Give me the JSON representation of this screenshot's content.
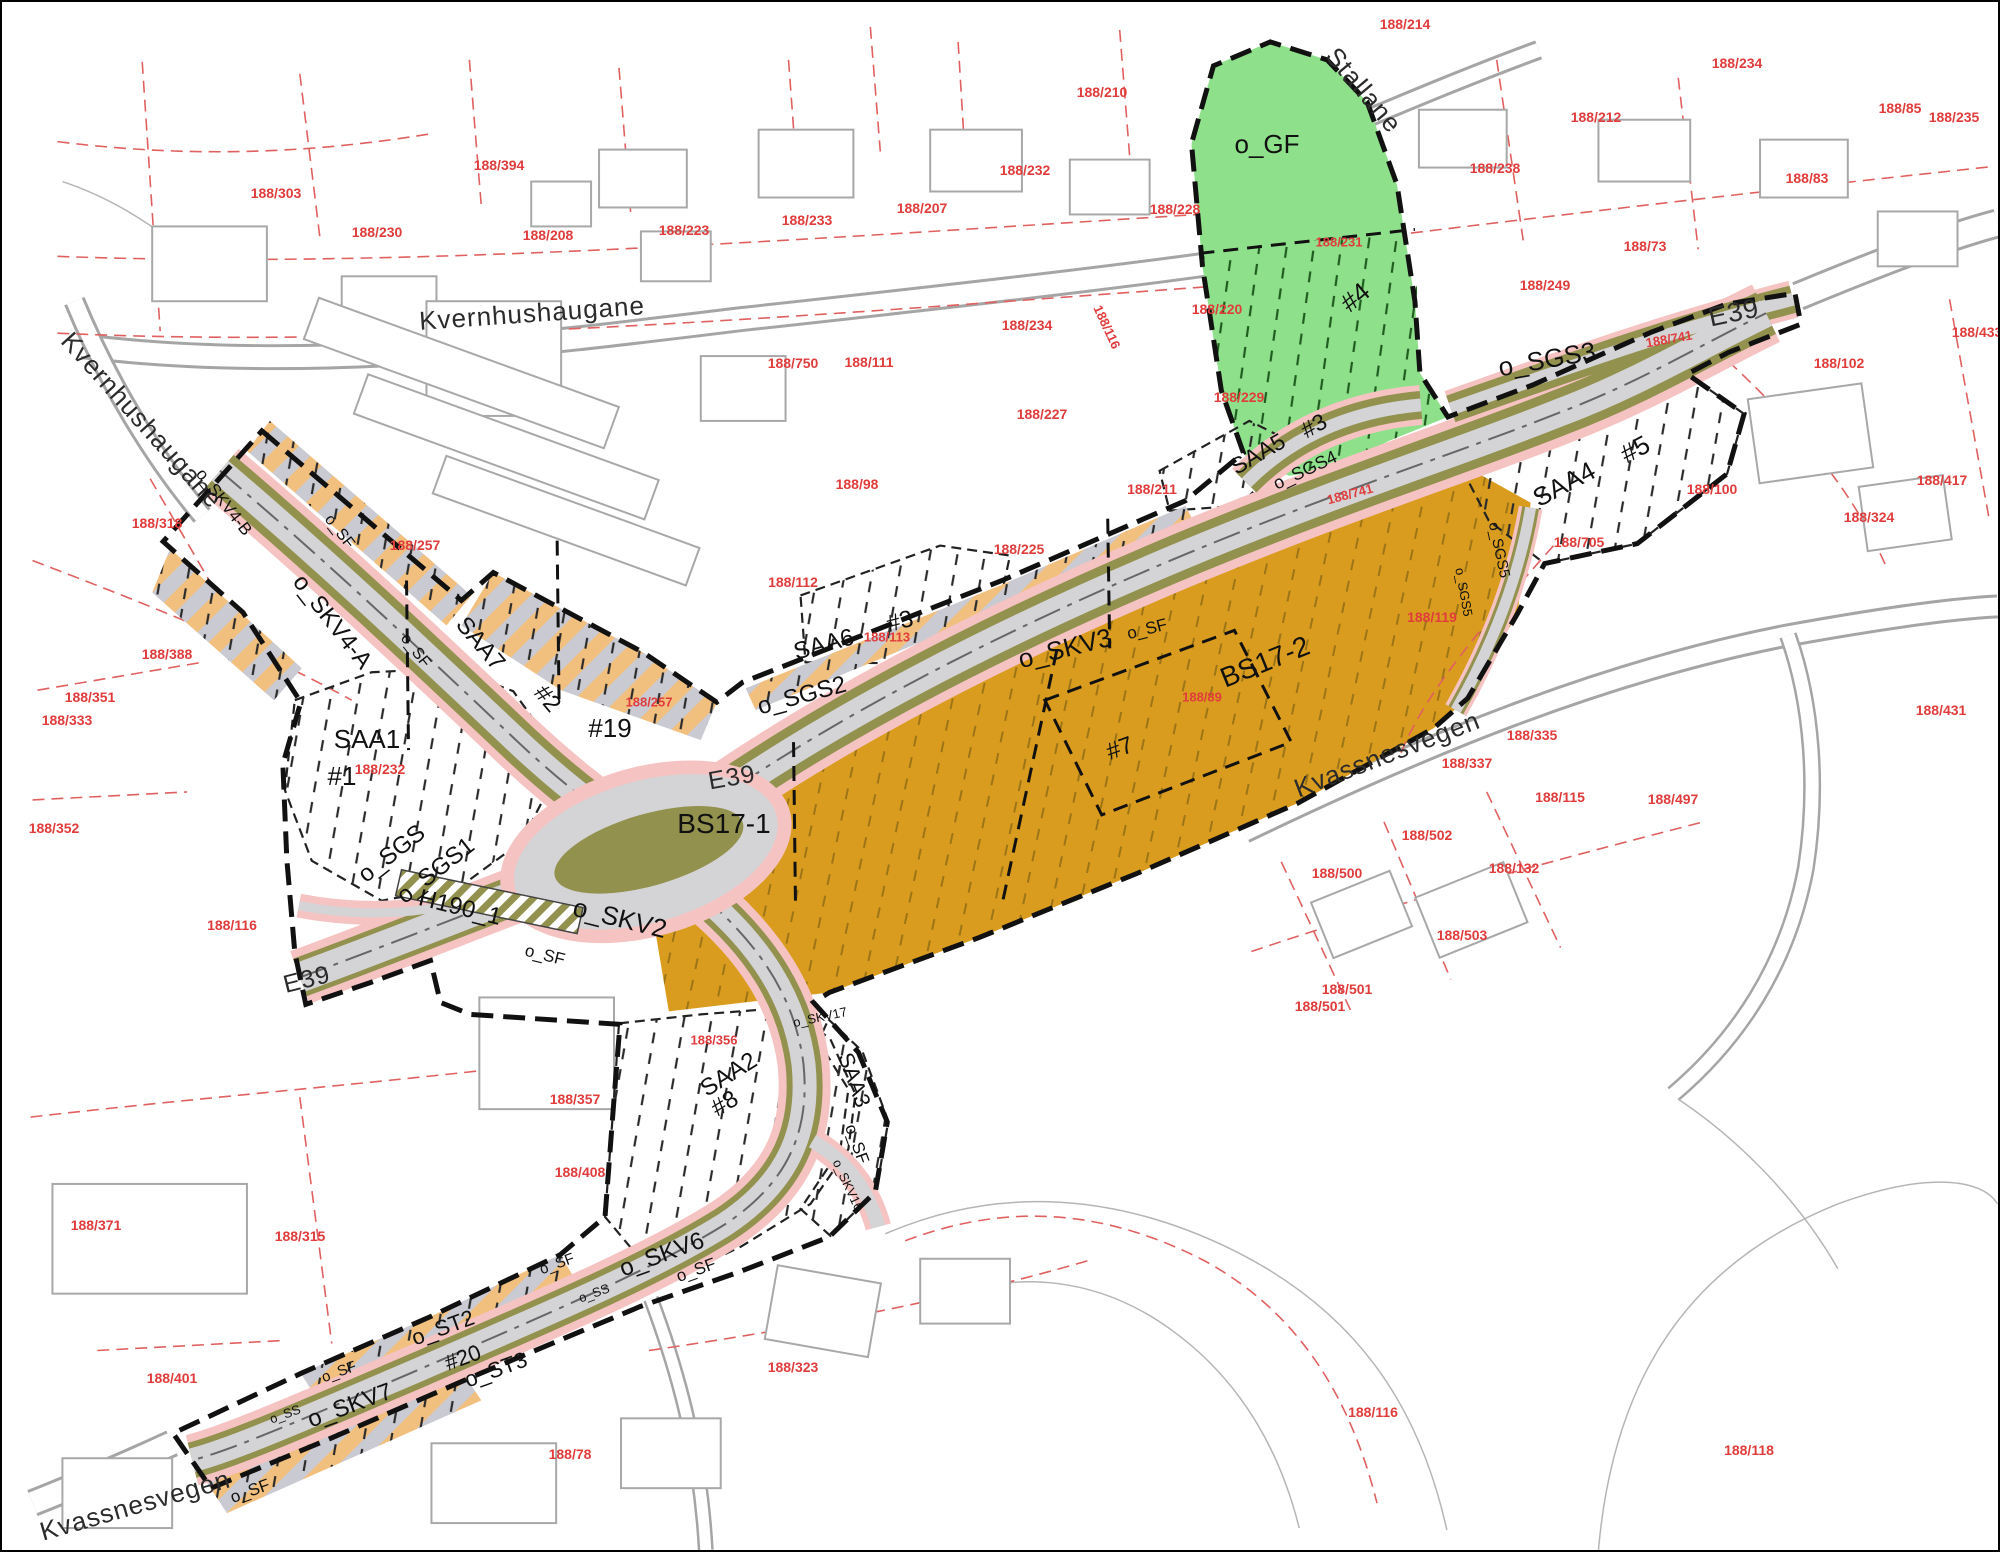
{
  "map": {
    "type": "zoning-plan (reguleringsplan) map",
    "palette": {
      "green": "#8fe08b",
      "olive": "#93914e",
      "orange": "#d99c1e",
      "roadgrey": "#d4d4d6",
      "pink": "#f5c3c2",
      "hatch_orange": "#f2c07e",
      "hatch_grey": "#c9cad2",
      "parcel_red": "#e03c3c",
      "parcel_line": "#e06060",
      "ink": "#111111",
      "street_ink": "#2b2b2b",
      "bldg": "#a8a8a8"
    },
    "labels": {
      "streets": [
        {
          "t": "Kvernhushaugane",
          "x": 530,
          "y": 311,
          "r": -4,
          "s": 26
        },
        {
          "t": "Kvernhushaugane",
          "x": 140,
          "y": 418,
          "r": 48,
          "s": 26
        },
        {
          "t": "Stallane",
          "x": 1362,
          "y": 88,
          "r": 50,
          "s": 26
        },
        {
          "t": "E39",
          "x": 1732,
          "y": 311,
          "r": -12,
          "s": 27
        },
        {
          "t": "E39",
          "x": 730,
          "y": 776,
          "r": -10,
          "s": 25
        },
        {
          "t": "E39",
          "x": 305,
          "y": 978,
          "r": -14,
          "s": 25
        },
        {
          "t": "Kvassnesvegen",
          "x": 1385,
          "y": 752,
          "r": -21,
          "s": 26
        },
        {
          "t": "Kvassnesvegen",
          "x": 133,
          "y": 1503,
          "r": -16,
          "s": 26
        }
      ],
      "zones": [
        {
          "t": "o_GF",
          "x": 1265,
          "y": 142,
          "r": 0,
          "s": 26
        },
        {
          "t": "#4",
          "x": 1353,
          "y": 295,
          "r": -40,
          "s": 26
        },
        {
          "t": "o_SGS3",
          "x": 1545,
          "y": 357,
          "r": -10,
          "s": 26
        },
        {
          "t": "SAA4",
          "x": 1562,
          "y": 482,
          "r": -28,
          "s": 26
        },
        {
          "t": "#5",
          "x": 1633,
          "y": 447,
          "r": -28,
          "s": 26
        },
        {
          "t": "SAA5",
          "x": 1256,
          "y": 452,
          "r": -30,
          "s": 23
        },
        {
          "t": "#3",
          "x": 1312,
          "y": 424,
          "r": -30,
          "s": 23
        },
        {
          "t": "o_SGS4",
          "x": 1303,
          "y": 468,
          "r": -25,
          "s": 18
        },
        {
          "t": "o_SGS5",
          "x": 1497,
          "y": 548,
          "r": 78,
          "s": 15
        },
        {
          "t": "o_SGS5",
          "x": 1462,
          "y": 590,
          "r": 80,
          "s": 13
        },
        {
          "t": "SAA6",
          "x": 822,
          "y": 643,
          "r": -15,
          "s": 24
        },
        {
          "t": "#3",
          "x": 898,
          "y": 620,
          "r": -15,
          "s": 24
        },
        {
          "t": "o_SGS2",
          "x": 800,
          "y": 694,
          "r": -15,
          "s": 24
        },
        {
          "t": "o_SKV3",
          "x": 1063,
          "y": 646,
          "r": -14,
          "s": 26
        },
        {
          "t": "BS17-2",
          "x": 1263,
          "y": 660,
          "r": -22,
          "s": 28
        },
        {
          "t": "BS17-1",
          "x": 722,
          "y": 822,
          "r": 0,
          "s": 28
        },
        {
          "t": "#7",
          "x": 1118,
          "y": 747,
          "r": -20,
          "s": 24
        },
        {
          "t": "o_SKV4-B",
          "x": 222,
          "y": 500,
          "r": 52,
          "s": 17
        },
        {
          "t": "o_SKV4-A",
          "x": 330,
          "y": 620,
          "r": 52,
          "s": 24
        },
        {
          "t": "SAA7",
          "x": 478,
          "y": 642,
          "r": 50,
          "s": 24
        },
        {
          "t": "#2",
          "x": 545,
          "y": 697,
          "r": 50,
          "s": 24
        },
        {
          "t": "#19",
          "x": 608,
          "y": 726,
          "r": 0,
          "s": 26
        },
        {
          "t": "SAA1",
          "x": 365,
          "y": 737,
          "r": 0,
          "s": 26
        },
        {
          "t": "#1",
          "x": 340,
          "y": 774,
          "r": 0,
          "s": 26
        },
        {
          "t": "o_SGS",
          "x": 390,
          "y": 852,
          "r": -38,
          "s": 24
        },
        {
          "t": "o_SGS1",
          "x": 434,
          "y": 869,
          "r": -38,
          "s": 24
        },
        {
          "t": "H190_1",
          "x": 458,
          "y": 906,
          "r": 14,
          "s": 24
        },
        {
          "t": "o_SKV2",
          "x": 618,
          "y": 916,
          "r": 14,
          "s": 26
        },
        {
          "t": "SAA2",
          "x": 727,
          "y": 1073,
          "r": -32,
          "s": 24
        },
        {
          "t": "#8",
          "x": 723,
          "y": 1102,
          "r": -32,
          "s": 24
        },
        {
          "t": "SAA3",
          "x": 852,
          "y": 1078,
          "r": 70,
          "s": 22
        },
        {
          "t": "o_SKV6",
          "x": 660,
          "y": 1253,
          "r": -20,
          "s": 24
        },
        {
          "t": "o_ST2",
          "x": 441,
          "y": 1326,
          "r": -20,
          "s": 22
        },
        {
          "t": "#20",
          "x": 461,
          "y": 1356,
          "r": -20,
          "s": 22
        },
        {
          "t": "o_ST3",
          "x": 494,
          "y": 1368,
          "r": -20,
          "s": 22
        },
        {
          "t": "o_SKV7",
          "x": 348,
          "y": 1404,
          "r": -20,
          "s": 24
        },
        {
          "t": "o_SKV16",
          "x": 846,
          "y": 1183,
          "r": 65,
          "s": 13
        },
        {
          "t": "o_SKV17",
          "x": 818,
          "y": 1015,
          "r": -12,
          "s": 13
        },
        {
          "t": "o_SS",
          "x": 283,
          "y": 1412,
          "r": -20,
          "s": 13
        },
        {
          "t": "o_SS",
          "x": 592,
          "y": 1291,
          "r": -20,
          "s": 13
        },
        {
          "t": "o_SF",
          "x": 543,
          "y": 953,
          "r": 14,
          "s": 17
        },
        {
          "t": "o_SF",
          "x": 1145,
          "y": 627,
          "r": -14,
          "s": 17
        },
        {
          "t": "o_SF",
          "x": 413,
          "y": 649,
          "r": 52,
          "s": 16
        },
        {
          "t": "o_SF",
          "x": 337,
          "y": 530,
          "r": 52,
          "s": 16
        },
        {
          "t": "o_SF",
          "x": 855,
          "y": 1142,
          "r": 70,
          "s": 17
        },
        {
          "t": "o_SF",
          "x": 694,
          "y": 1268,
          "r": -20,
          "s": 17
        },
        {
          "t": "o_SF",
          "x": 248,
          "y": 1489,
          "r": -20,
          "s": 17
        },
        {
          "t": "o_SF",
          "x": 337,
          "y": 1370,
          "r": -20,
          "s": 15
        },
        {
          "t": "o_SF",
          "x": 555,
          "y": 1262,
          "r": -20,
          "s": 15
        }
      ],
      "parcels": [
        {
          "t": "188/303",
          "x": 274,
          "y": 191,
          "r": 0,
          "s": 14
        },
        {
          "t": "188/230",
          "x": 375,
          "y": 230,
          "r": 0,
          "s": 14
        },
        {
          "t": "188/394",
          "x": 497,
          "y": 163,
          "r": 0,
          "s": 14
        },
        {
          "t": "188/208",
          "x": 546,
          "y": 233,
          "r": 0,
          "s": 14
        },
        {
          "t": "188/223",
          "x": 682,
          "y": 228,
          "r": 0,
          "s": 14
        },
        {
          "t": "188/233",
          "x": 805,
          "y": 218,
          "r": 0,
          "s": 14
        },
        {
          "t": "188/207",
          "x": 920,
          "y": 206,
          "r": 0,
          "s": 14
        },
        {
          "t": "188/232",
          "x": 1023,
          "y": 168,
          "r": 0,
          "s": 14
        },
        {
          "t": "188/210",
          "x": 1100,
          "y": 90,
          "r": 0,
          "s": 14
        },
        {
          "t": "188/228",
          "x": 1173,
          "y": 207,
          "r": 0,
          "s": 14
        },
        {
          "t": "188/214",
          "x": 1403,
          "y": 22,
          "r": 0,
          "s": 14
        },
        {
          "t": "188/238",
          "x": 1493,
          "y": 166,
          "r": 0,
          "s": 14
        },
        {
          "t": "188/212",
          "x": 1594,
          "y": 115,
          "r": 0,
          "s": 14
        },
        {
          "t": "188/234",
          "x": 1735,
          "y": 61,
          "r": 0,
          "s": 14
        },
        {
          "t": "188/85",
          "x": 1898,
          "y": 106,
          "r": 0,
          "s": 14
        },
        {
          "t": "188/235",
          "x": 1952,
          "y": 115,
          "r": 0,
          "s": 14
        },
        {
          "t": "188/83",
          "x": 1805,
          "y": 176,
          "r": 0,
          "s": 14
        },
        {
          "t": "188/73",
          "x": 1643,
          "y": 244,
          "r": 0,
          "s": 14
        },
        {
          "t": "188/249",
          "x": 1543,
          "y": 283,
          "r": 0,
          "s": 14
        },
        {
          "t": "188/220",
          "x": 1215,
          "y": 307,
          "r": 0,
          "s": 14
        },
        {
          "t": "188/229",
          "x": 1237,
          "y": 395,
          "r": 0,
          "s": 14
        },
        {
          "t": "188/227",
          "x": 1040,
          "y": 412,
          "r": 0,
          "s": 14
        },
        {
          "t": "188/234",
          "x": 1025,
          "y": 323,
          "r": 0,
          "s": 14
        },
        {
          "t": "188/116",
          "x": 1105,
          "y": 325,
          "r": 65,
          "s": 13
        },
        {
          "t": "188/111",
          "x": 867,
          "y": 360,
          "r": 0,
          "s": 14
        },
        {
          "t": "188/750",
          "x": 791,
          "y": 361,
          "r": 0,
          "s": 14
        },
        {
          "t": "188/112",
          "x": 791,
          "y": 580,
          "r": 0,
          "s": 14
        },
        {
          "t": "188/211",
          "x": 1150,
          "y": 487,
          "r": 0,
          "s": 14
        },
        {
          "t": "188/225",
          "x": 1017,
          "y": 547,
          "r": 0,
          "s": 14
        },
        {
          "t": "188/98",
          "x": 855,
          "y": 482,
          "r": 0,
          "s": 14
        },
        {
          "t": "188/231",
          "x": 1337,
          "y": 240,
          "r": 0,
          "s": 13
        },
        {
          "t": "188/741",
          "x": 1348,
          "y": 492,
          "r": -15,
          "s": 13
        },
        {
          "t": "188/741",
          "x": 1667,
          "y": 337,
          "r": -10,
          "s": 13
        },
        {
          "t": "188/102",
          "x": 1837,
          "y": 361,
          "r": 0,
          "s": 14
        },
        {
          "t": "188/100",
          "x": 1710,
          "y": 487,
          "r": 0,
          "s": 14
        },
        {
          "t": "188/324",
          "x": 1867,
          "y": 515,
          "r": 0,
          "s": 14
        },
        {
          "t": "188/417",
          "x": 1940,
          "y": 478,
          "r": 0,
          "s": 14
        },
        {
          "t": "188/433",
          "x": 1975,
          "y": 330,
          "r": 0,
          "s": 14
        },
        {
          "t": "188/431",
          "x": 1939,
          "y": 708,
          "r": 0,
          "s": 14
        },
        {
          "t": "188/705",
          "x": 1577,
          "y": 540,
          "r": 0,
          "s": 14
        },
        {
          "t": "188/257",
          "x": 413,
          "y": 543,
          "r": 0,
          "s": 14
        },
        {
          "t": "188/257",
          "x": 647,
          "y": 700,
          "r": 0,
          "s": 13
        },
        {
          "t": "188/232",
          "x": 378,
          "y": 767,
          "r": 0,
          "s": 14
        },
        {
          "t": "188/318",
          "x": 155,
          "y": 521,
          "r": 0,
          "s": 14
        },
        {
          "t": "188/388",
          "x": 165,
          "y": 652,
          "r": 0,
          "s": 14
        },
        {
          "t": "188/351",
          "x": 88,
          "y": 695,
          "r": 0,
          "s": 14
        },
        {
          "t": "188/333",
          "x": 65,
          "y": 718,
          "r": 0,
          "s": 14
        },
        {
          "t": "188/352",
          "x": 52,
          "y": 826,
          "r": 0,
          "s": 14
        },
        {
          "t": "188/116",
          "x": 230,
          "y": 923,
          "r": 0,
          "s": 14
        },
        {
          "t": "188/113",
          "x": 885,
          "y": 635,
          "r": 0,
          "s": 13
        },
        {
          "t": "188/89",
          "x": 1200,
          "y": 695,
          "r": 0,
          "s": 13
        },
        {
          "t": "188/119",
          "x": 1430,
          "y": 615,
          "r": 0,
          "s": 14
        },
        {
          "t": "188/335",
          "x": 1530,
          "y": 733,
          "r": 0,
          "s": 14
        },
        {
          "t": "188/337",
          "x": 1465,
          "y": 761,
          "r": 0,
          "s": 14
        },
        {
          "t": "188/115",
          "x": 1558,
          "y": 795,
          "r": 0,
          "s": 14
        },
        {
          "t": "188/497",
          "x": 1671,
          "y": 797,
          "r": 0,
          "s": 14
        },
        {
          "t": "188/502",
          "x": 1425,
          "y": 833,
          "r": 0,
          "s": 14
        },
        {
          "t": "188/500",
          "x": 1335,
          "y": 871,
          "r": 0,
          "s": 14
        },
        {
          "t": "188/132",
          "x": 1512,
          "y": 866,
          "r": 0,
          "s": 14
        },
        {
          "t": "188/503",
          "x": 1460,
          "y": 933,
          "r": 0,
          "s": 14
        },
        {
          "t": "188/501",
          "x": 1345,
          "y": 987,
          "r": 0,
          "s": 14
        },
        {
          "t": "188/501",
          "x": 1318,
          "y": 1004,
          "r": 0,
          "s": 14
        },
        {
          "t": "188/356",
          "x": 712,
          "y": 1038,
          "r": 0,
          "s": 13
        },
        {
          "t": "188/357",
          "x": 573,
          "y": 1097,
          "r": 0,
          "s": 14
        },
        {
          "t": "188/371",
          "x": 94,
          "y": 1223,
          "r": 0,
          "s": 14
        },
        {
          "t": "188/315",
          "x": 298,
          "y": 1234,
          "r": 0,
          "s": 14
        },
        {
          "t": "188/408",
          "x": 578,
          "y": 1170,
          "r": 0,
          "s": 14
        },
        {
          "t": "188/401",
          "x": 170,
          "y": 1376,
          "r": 0,
          "s": 14
        },
        {
          "t": "188/78",
          "x": 568,
          "y": 1452,
          "r": 0,
          "s": 14
        },
        {
          "t": "188/323",
          "x": 791,
          "y": 1365,
          "r": 0,
          "s": 14
        },
        {
          "t": "188/116",
          "x": 1371,
          "y": 1410,
          "r": 0,
          "s": 14
        },
        {
          "t": "188/118",
          "x": 1747,
          "y": 1448,
          "r": 0,
          "s": 14
        }
      ]
    }
  }
}
